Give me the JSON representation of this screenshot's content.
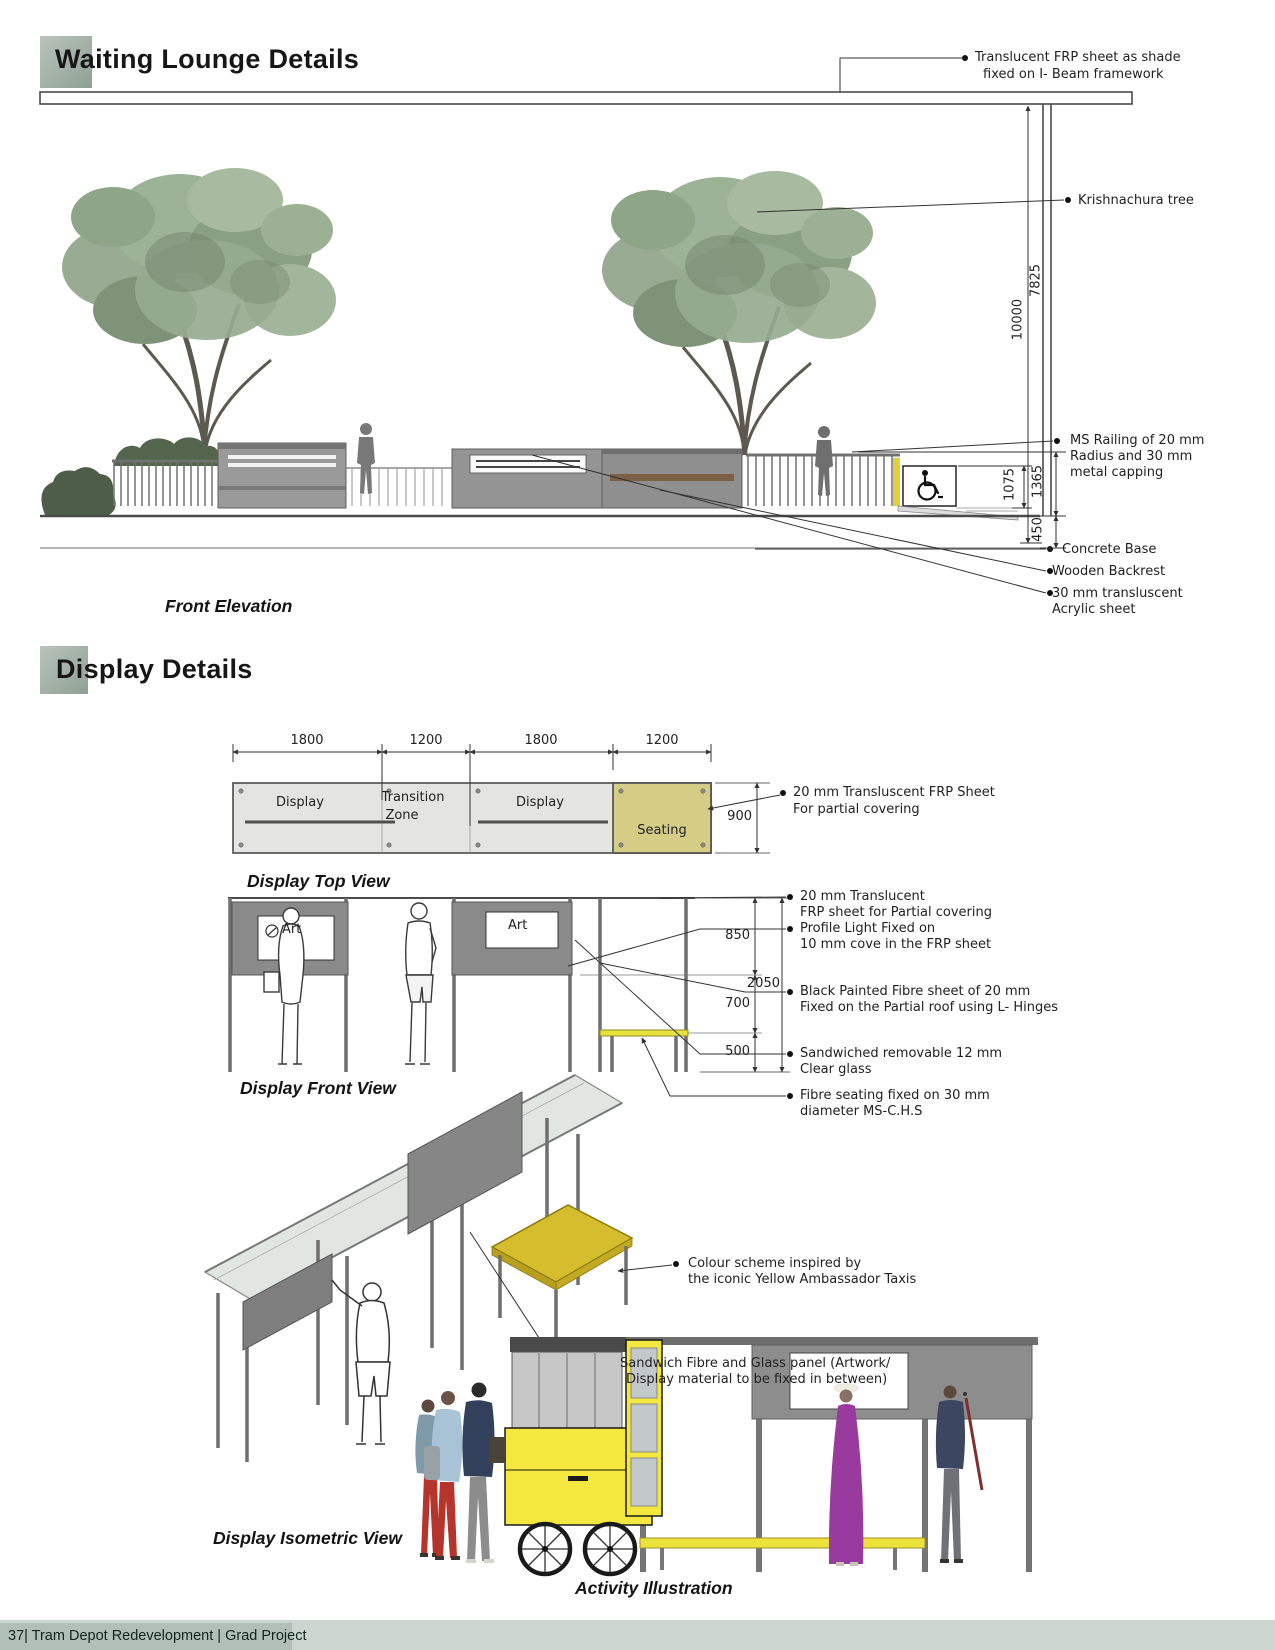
{
  "page": {
    "title": "Waiting Lounge Details",
    "section2_title": "Display Details",
    "footer_text": "37| Tram Depot Redevelopment | Grad Project"
  },
  "front_elevation": {
    "caption": "Front Elevation",
    "annotations": {
      "frp_shade_1": "Translucent FRP sheet as shade",
      "frp_shade_2": "fixed on I- Beam framework",
      "tree": "Krishnachura tree",
      "railing_1": "MS Railing of 20 mm",
      "railing_2": "Radius and 30 mm",
      "railing_3": "metal capping",
      "concrete_base": "Concrete Base",
      "wooden_backrest": "Wooden Backrest",
      "acrylic_1": "30 mm transluscent",
      "acrylic_2": "Acrylic sheet"
    },
    "dimensions": {
      "height_total": "10000",
      "height_canopy": "7825",
      "height_railing": "1365",
      "height_sign": "1075",
      "base_depth": "450"
    }
  },
  "display_top_view": {
    "caption": "Display Top View",
    "dimensions": {
      "d1": "1800",
      "d2": "1200",
      "d3": "1800",
      "d4": "1200",
      "depth": "900"
    },
    "zones": {
      "display_a": "Display",
      "transition_1": "Transition",
      "transition_2": "Zone",
      "display_b": "Display",
      "seating": "Seating"
    },
    "annotations": {
      "frp_1": "20 mm Transluscent FRP Sheet",
      "frp_2": "For partial covering"
    }
  },
  "display_front_view": {
    "caption": "Display Front View",
    "art_label_a": "Art",
    "art_label_b": "Art",
    "dimensions": {
      "top": "850",
      "middle": "700",
      "bottom": "500",
      "total": "2050"
    },
    "annotations": {
      "translucent_1": "20 mm Translucent",
      "translucent_2": "FRP sheet for Partial covering",
      "profile_light_1": "Profile Light Fixed on",
      "profile_light_2": "10 mm cove in the FRP sheet",
      "fibre_sheet_1": "Black Painted Fibre sheet of 20 mm",
      "fibre_sheet_2": "Fixed on the Partial roof using L- Hinges",
      "glass_1": "Sandwiched removable 12 mm",
      "glass_2": "Clear glass",
      "seating_1": "Fibre seating fixed on 30 mm",
      "seating_2": "diameter MS-C.H.S"
    }
  },
  "display_isometric": {
    "caption": "Display Isometric View",
    "annotations": {
      "colour_1": "Colour scheme inspired by",
      "colour_2": "the iconic Yellow Ambassador Taxis",
      "panel_1": "Sandwich Fibre and Glass panel (Artwork/",
      "panel_2": "Display material to be fixed in between)"
    }
  },
  "activity": {
    "caption": "Activity Illustration"
  },
  "colors": {
    "accent_square": "#a7b5ab",
    "seating_olive": "#d5cd85",
    "taxi_yellow": "#f4e73e",
    "iso_seat_yellow": "#d6bd2e",
    "panel_gray": "#8d8d8d",
    "foliage_green": "#96ab90",
    "footer_bar": "#b2bfb8"
  }
}
